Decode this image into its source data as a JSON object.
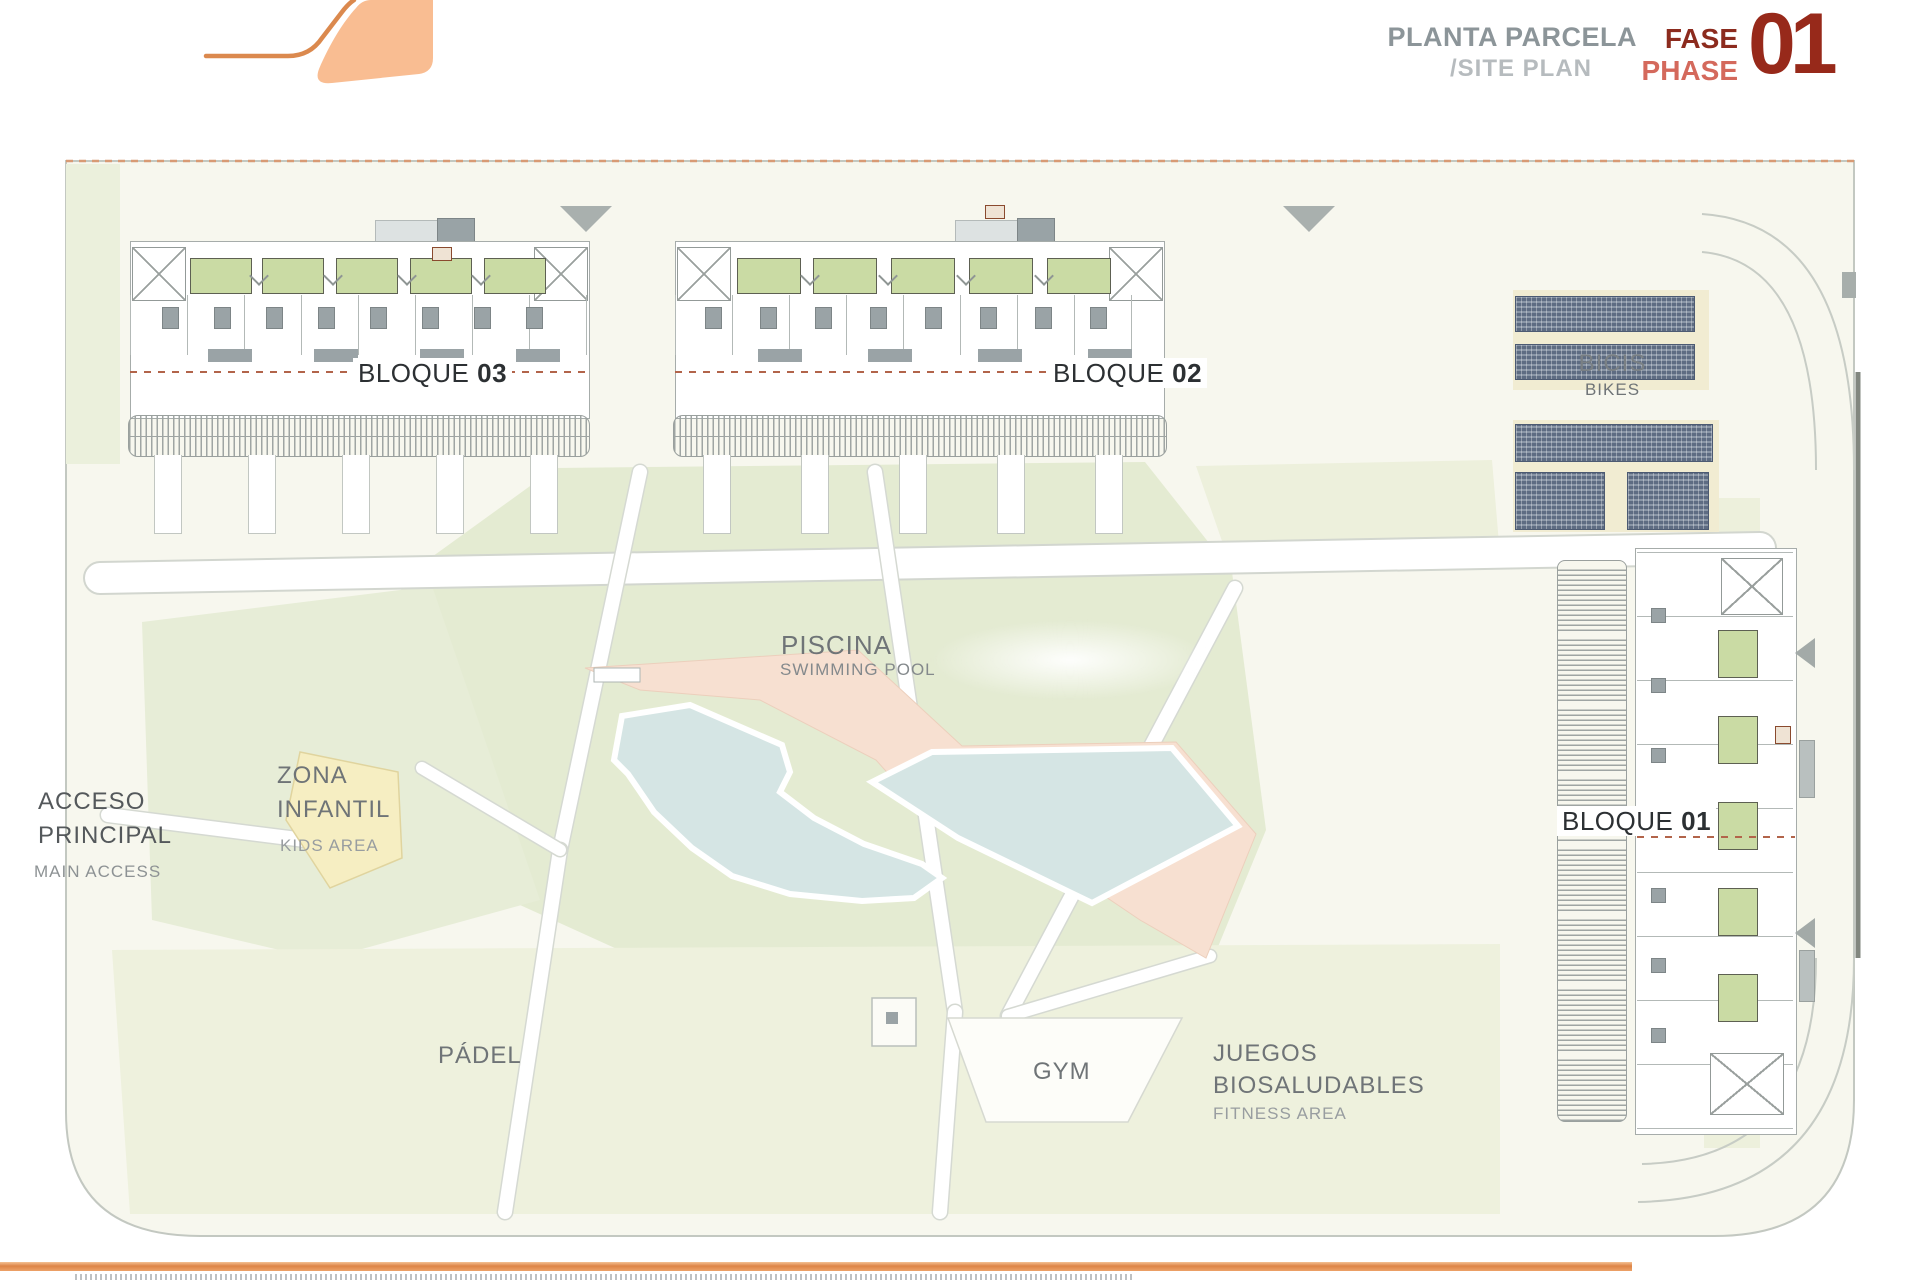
{
  "header": {
    "title_es": "PLANTA PARCELA",
    "title_en": "/SITE PLAN",
    "phase_label_es": "FASE",
    "phase_label_en": "PHASE",
    "phase_number": "01"
  },
  "plan": {
    "blocks": {
      "b03": {
        "label": "BLOQUE",
        "number": "03"
      },
      "b02": {
        "label": "BLOQUE",
        "number": "02"
      },
      "b01": {
        "label": "BLOQUE",
        "number": "01"
      }
    },
    "areas": {
      "bikes": {
        "es": "BICIS",
        "en": "BIKES"
      },
      "pool": {
        "es": "PISCINA",
        "en": "SWIMMING POOL"
      },
      "kids": {
        "es_line1": "ZONA",
        "es_line2": "INFANTIL",
        "en": "KIDS AREA"
      },
      "access": {
        "es_line1": "ACCESO",
        "es_line2": "PRINCIPAL",
        "en": "MAIN ACCESS"
      },
      "padel": {
        "es": "PÁDEL"
      },
      "gym": {
        "es": "GYM"
      },
      "fitness": {
        "es_line1": "JUEGOS",
        "es_line2": "BIOSALUDABLES",
        "en": "FITNESS AREA"
      }
    }
  },
  "colors": {
    "accent_orange": "#dd8446",
    "logo_fill": "#f9bd92",
    "phase_dark_red": "#8c2b1e",
    "phase_salmon": "#d4695c",
    "phase_number_red": "#97291a",
    "title_gray": "#8c9599",
    "title_light_gray": "#b6bbbe",
    "label_dark": "#2c3033",
    "label_gray": "#6f7477",
    "label_light_gray": "#989da0",
    "parcel_bg": "#f7f7ee",
    "lawn_green": "#e4ebd2",
    "terrace_green": "#cadba4",
    "court_green": "#c7d6b6",
    "pool_blue": "#d5e5e4",
    "pool_deck_salmon": "#f7e0d1",
    "kids_yellow": "#f6eec2",
    "bike_slate": "#5e6c82",
    "sand": "#f1ecd2",
    "dashed_boundary": "#d89a74"
  }
}
